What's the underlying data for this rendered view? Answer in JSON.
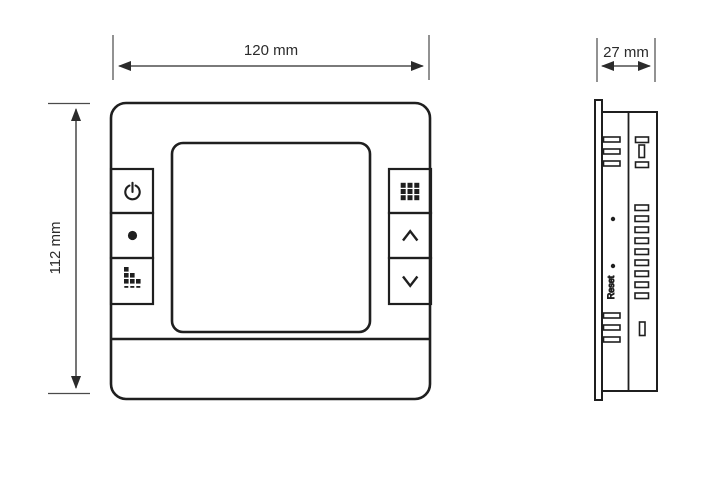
{
  "dimensions": {
    "front_width": "120 mm",
    "front_height": "112 mm",
    "side_depth": "27 mm"
  },
  "front_view": {
    "left_buttons": [
      {
        "name": "power-button",
        "icon": "power-icon"
      },
      {
        "name": "indicator-button",
        "icon": "dot-icon"
      },
      {
        "name": "fan-speed-button",
        "icon": "fan-speed-icon"
      }
    ],
    "right_buttons": [
      {
        "name": "menu-button",
        "icon": "menu-grid-icon"
      },
      {
        "name": "up-button",
        "icon": "chevron-up-icon"
      },
      {
        "name": "down-button",
        "icon": "chevron-down-icon"
      }
    ]
  },
  "side_view": {
    "reset_label": "Reset"
  },
  "colors": {
    "line": "#2b2b2b",
    "background": "#ffffff"
  }
}
